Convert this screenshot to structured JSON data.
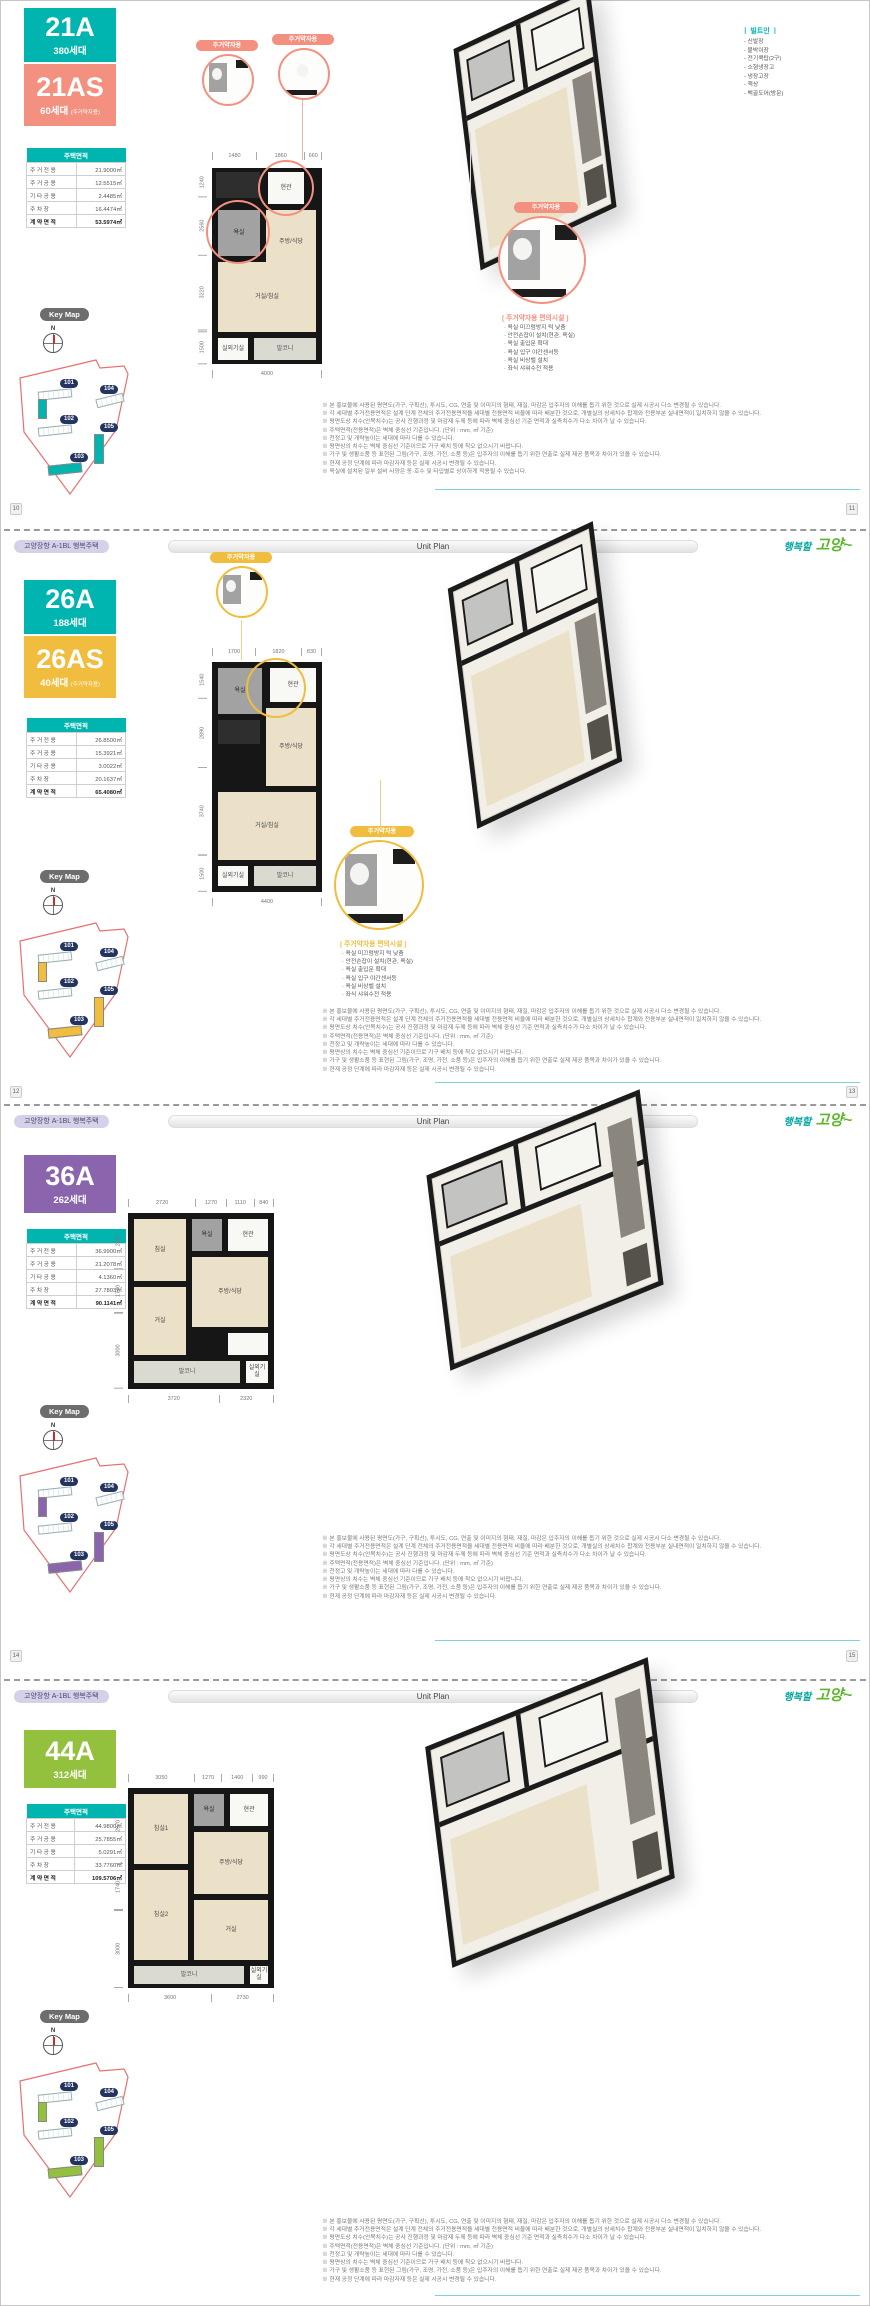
{
  "shared": {
    "header": {
      "project": "고양장항 A-1BL 행복주택",
      "unit_plan": "Unit Plan",
      "logo_small": "행복할",
      "logo_large": "고양~"
    },
    "keymap": {
      "label": "Key Map",
      "north": "N",
      "buildings": [
        "101",
        "104",
        "102",
        "105",
        "103"
      ]
    },
    "table": {
      "title": "주택면적",
      "row_labels": [
        "주거전용",
        "주거공용",
        "기타공용",
        "주차장",
        "계약면적"
      ]
    },
    "barrier_free": {
      "pill": "주거약자용",
      "title": "[ 주거약자용 편의시설 ]",
      "items": [
        "욕실 미끄럼방지 턱 낮춤",
        "안전손잡이 설치(현관, 욕실)",
        "욕실 출입문 확대",
        "욕실 입구 야간센서등",
        "욕실 비상벨 설치",
        "좌식 샤워수전 적용"
      ]
    },
    "legend": {
      "title": "ㅣ 빌트인 ㅣ",
      "items": [
        "신발장",
        "붙박이장",
        "전기쿡탑(2구)",
        "소형냉장고",
        "냉장고장",
        "책상",
        "백골도어(방문)"
      ]
    },
    "notes": [
      "※ 본 홍보물에 사용된 평면도(가구, 구획선), 투시도, CG, 연출 및 이미지의 형태, 재질, 마감은 입주자의 이해를 돕기 위한 것으로 실제 시공시 다소 변경될 수 있습니다.",
      "※ 각 세대별 주거전용면적은 설계 단계 전체의 주거전용면적을 세대별 전용면적 비율에 따라 배분한 것으로, 개별실의 상세치수 합계와 전용부분 실내면적이 일치하지 않을 수 있습니다.",
      "※ 평면도상 치수(안목치수)는 공사 진행과정 및 마감재 두께 등에 따라 벽체 중심선 기준 면적과 실측치수가 다소 차이가 날 수 있습니다.",
      "※ 주택면적(전용면적)은 벽체 중심선 기준입니다. (단위 : mm, ㎡ 기준)",
      "※ 천정고 및 개략높이는 세대에 따라 다를 수 있습니다.",
      "※ 평면상의 치수는 벽체 중심선 기준이므로 가구 배치 등에 착오 없으시기 바랍니다.",
      "※ 가구 및 생활소품 등 표현된 그림(가구, 조명, 가전, 소품 등)은 입주자의 이해를 돕기 위한 연출로 실제 제공 품목과 차이가 있을 수 있습니다.",
      "※ 현재 공정 단계에 따라 마감자재 등은 실제 시공시 변경될 수 있습니다.",
      "※ 욕실에 설치된 일부 설비 사양은 동·호수 및 타입별로 상이하게 적용될 수 있습니다."
    ],
    "colors": {
      "teal": "#00b5b0",
      "salmon": "#f4907f",
      "gold": "#f1bd3e",
      "purple": "#8a65ad",
      "green": "#94c13d",
      "navy": "#233460",
      "boundary": "#e87070"
    }
  },
  "sections": [
    {
      "type": "21",
      "accent": "#00b5b0",
      "callout_accent": "#f4907f",
      "pages": {
        "left": "10",
        "right": "11"
      },
      "badges": [
        {
          "code": "21A",
          "count": "380세대",
          "sub": "",
          "color": "#00b5b0"
        },
        {
          "code": "21AS",
          "count": "60세대",
          "sub": "(주거약자용)",
          "color": "#f4907f"
        }
      ],
      "table_values": [
        "21.9000㎡",
        "12.5515㎡",
        "2.4485㎡",
        "16.4474㎡",
        "53.5974㎡"
      ],
      "rooms": {
        "r1": "현관",
        "r2": "욕실",
        "r3": "주방/식당",
        "r4": "거실/침실",
        "r5": "실외기실",
        "r6": "발코니"
      },
      "dims": {
        "top": [
          "1480",
          "1860",
          "660"
        ],
        "left": [
          "1240",
          "2560",
          "3220",
          "1500"
        ],
        "bottom": [
          "4000"
        ]
      }
    },
    {
      "type": "26",
      "accent": "#f1bd3e",
      "callout_accent": "#f1bd3e",
      "pages": {
        "left": "12",
        "right": "13"
      },
      "badges": [
        {
          "code": "26A",
          "count": "188세대",
          "sub": "",
          "color": "#00b5b0"
        },
        {
          "code": "26AS",
          "count": "40세대",
          "sub": "(주거약자용)",
          "color": "#f1bd3e"
        }
      ],
      "table_values": [
        "26.8500㎡",
        "15.3921㎡",
        "3.0022㎡",
        "20.1637㎡",
        "65.4080㎡"
      ],
      "rooms": {
        "r1": "현관",
        "r2": "욕실",
        "r3": "주방/식당",
        "r4": "거실/침실",
        "r5": "실외기실",
        "r6": "발코니"
      },
      "dims": {
        "top": [
          "1700",
          "1820",
          "830"
        ],
        "left": [
          "1540",
          "2890",
          "3740",
          "1500"
        ],
        "bottom": [
          "4400"
        ]
      }
    },
    {
      "type": "36",
      "accent": "#8a65ad",
      "callout_accent": "#8a65ad",
      "pages": {
        "left": "14",
        "right": "15"
      },
      "badges": [
        {
          "code": "36A",
          "count": "262세대",
          "sub": "",
          "color": "#8a65ad"
        }
      ],
      "table_values": [
        "36.9900㎡",
        "21.2078㎡",
        "4.1360㎡",
        "27.7803㎡",
        "90.1141㎡"
      ],
      "rooms": {
        "r1": "침실",
        "r2": "욕실",
        "r3": "현관",
        "r4": "주방/식당",
        "r5": "거실",
        "r6": "발코니",
        "r7": "실외기실"
      },
      "dims": {
        "top": [
          "2720",
          "1270",
          "1110",
          "840"
        ],
        "left": [
          "2240",
          "1740",
          "3000"
        ],
        "bottom": [
          "3720",
          "2320"
        ]
      }
    },
    {
      "type": "44",
      "accent": "#94c13d",
      "callout_accent": "#94c13d",
      "badges": [
        {
          "code": "44A",
          "count": "312세대",
          "sub": "",
          "color": "#94c13d"
        }
      ],
      "table_values": [
        "44.9800㎡",
        "25.7855㎡",
        "5.0291㎡",
        "33.7760㎡",
        "109.5706㎡"
      ],
      "rooms": {
        "r1": "침실1",
        "r2": "욕실",
        "r3": "현관",
        "r4": "주방/식당",
        "r5": "거실",
        "r6": "침실2",
        "r7": "발코니",
        "r8": "실외기실"
      },
      "dims": {
        "top": [
          "3050",
          "1270",
          "1460",
          "990"
        ],
        "left": [
          "2970",
          "1740",
          "3000"
        ],
        "bottom": [
          "3600",
          "2730"
        ]
      }
    }
  ]
}
